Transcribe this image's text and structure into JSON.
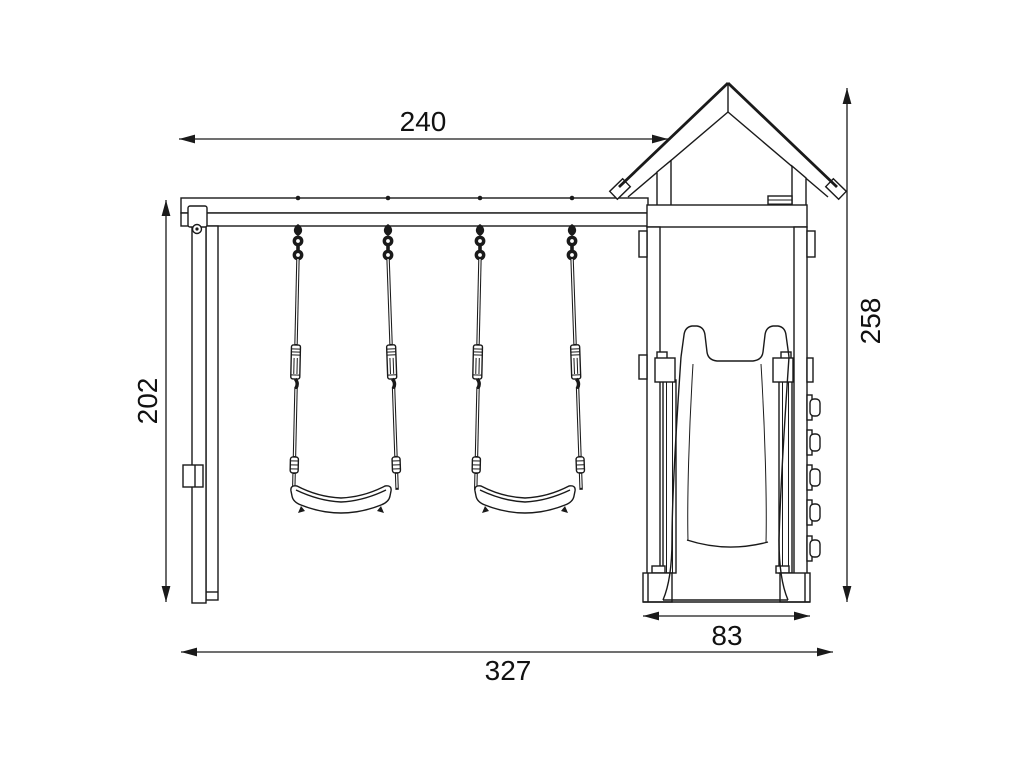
{
  "diagram": {
    "dimensions": {
      "top_width": "240",
      "left_height": "202",
      "right_height": "258",
      "tower_width": "83",
      "total_width": "327"
    },
    "colors": {
      "line": "#1a1a1a",
      "background": "#ffffff"
    }
  }
}
